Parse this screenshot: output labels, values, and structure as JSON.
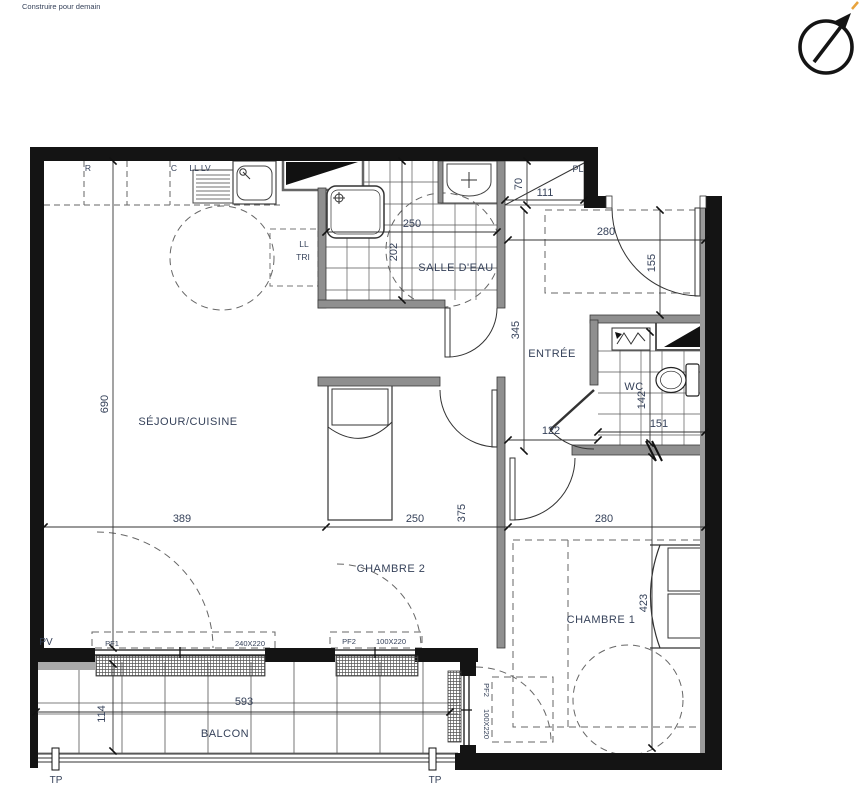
{
  "branding": {
    "logo": "Construire pour demain"
  },
  "labels": {
    "sejour": "SÉJOUR/CUISINE",
    "salle_deau": "SALLE D'EAU",
    "entree": "ENTRÉE",
    "wc": "WC",
    "chambre1": "CHAMBRE 1",
    "chambre2": "CHAMBRE 2",
    "balcon": "BALCON",
    "pl": "PL",
    "pv": "PV",
    "pf1": "PF1",
    "pf1_size": "240X220",
    "pf2": "PF2",
    "pf2_size": "100X220",
    "pf2v": "PF2",
    "pf2v_size": "100X220",
    "tp_left": "TP",
    "tp_right": "TP",
    "kitchen_r": "R",
    "kitchen_c": "C",
    "kitchen_ll_lv": "LL LV",
    "ll": "LL",
    "tri": "TRI"
  },
  "dims": {
    "sejour_h": "690",
    "sejour_w": "389",
    "sde_w": "250",
    "sde_h": "202",
    "pl_h": "70",
    "pl_w": "111",
    "entry_w": "280",
    "entry_h": "155",
    "entree_len": "345",
    "hall_w": "122",
    "wc_w": "151",
    "wc_h": "142",
    "ch2_w": "250",
    "ch2_h": "375",
    "ch1_w": "280",
    "ch1_h": "423",
    "balcon_w": "593",
    "balcon_h": "114"
  },
  "colors": {
    "wall": "#141414",
    "partition": "#8f8f8f",
    "dim_text": "#36425a",
    "logo_blue": "#4356a8",
    "compass_accent": "#e8a33d"
  }
}
